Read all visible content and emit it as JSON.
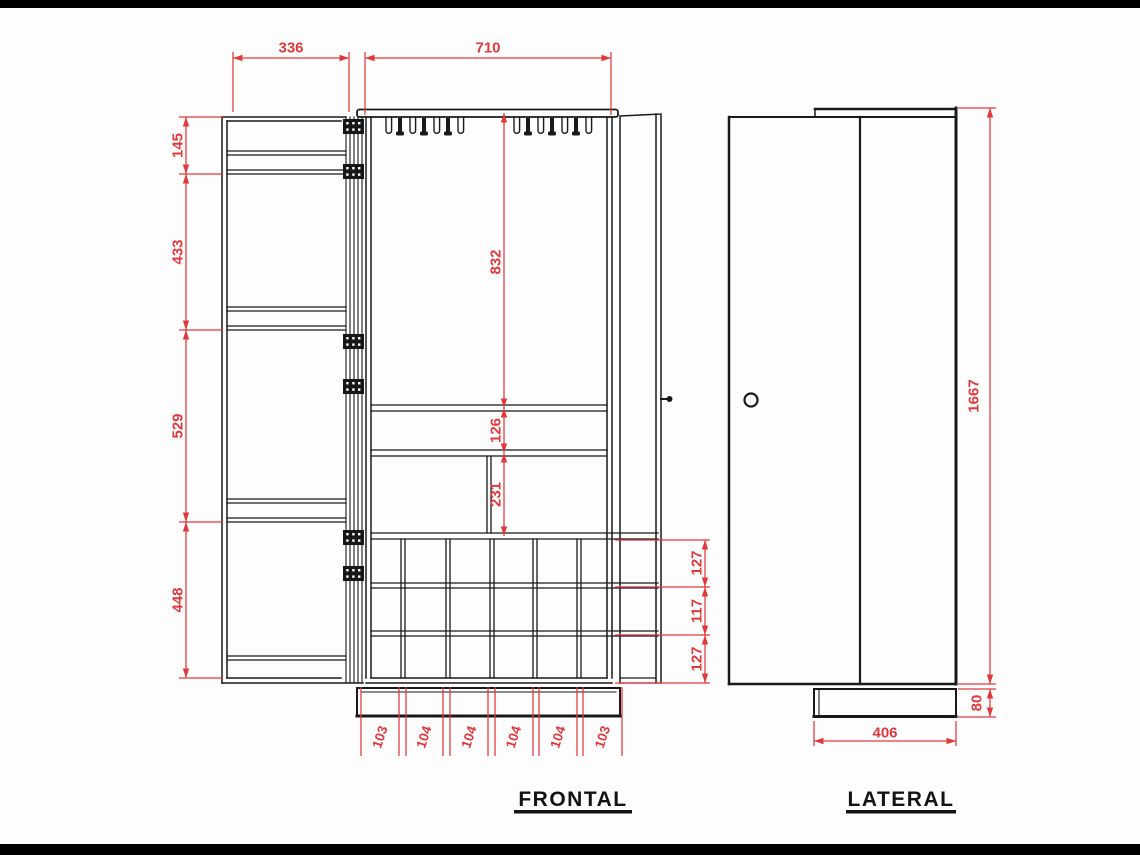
{
  "drawing": {
    "title": "cabinet technical drawing, frontal and lateral views",
    "colors": {
      "dimension_red": "#e2383c",
      "line_black": "#191919"
    },
    "views": {
      "frontal": {
        "label": "FRONTAL",
        "dims": {
          "open_door_width": "336",
          "cabinet_width": "710",
          "door_shelf_spacings": [
            "145",
            "433",
            "529",
            "448"
          ],
          "upper_compartment_height": "832",
          "shelf_section_height": "126",
          "middle_section_height": "231",
          "wine_rack_row_heights": [
            "127",
            "117",
            "127"
          ],
          "wine_rack_column_widths": [
            "103",
            "104",
            "104",
            "104",
            "104",
            "103"
          ]
        }
      },
      "lateral": {
        "label": "LATERAL",
        "dims": {
          "total_height": "1667",
          "plinth_height": "80",
          "depth": "406"
        }
      }
    }
  }
}
